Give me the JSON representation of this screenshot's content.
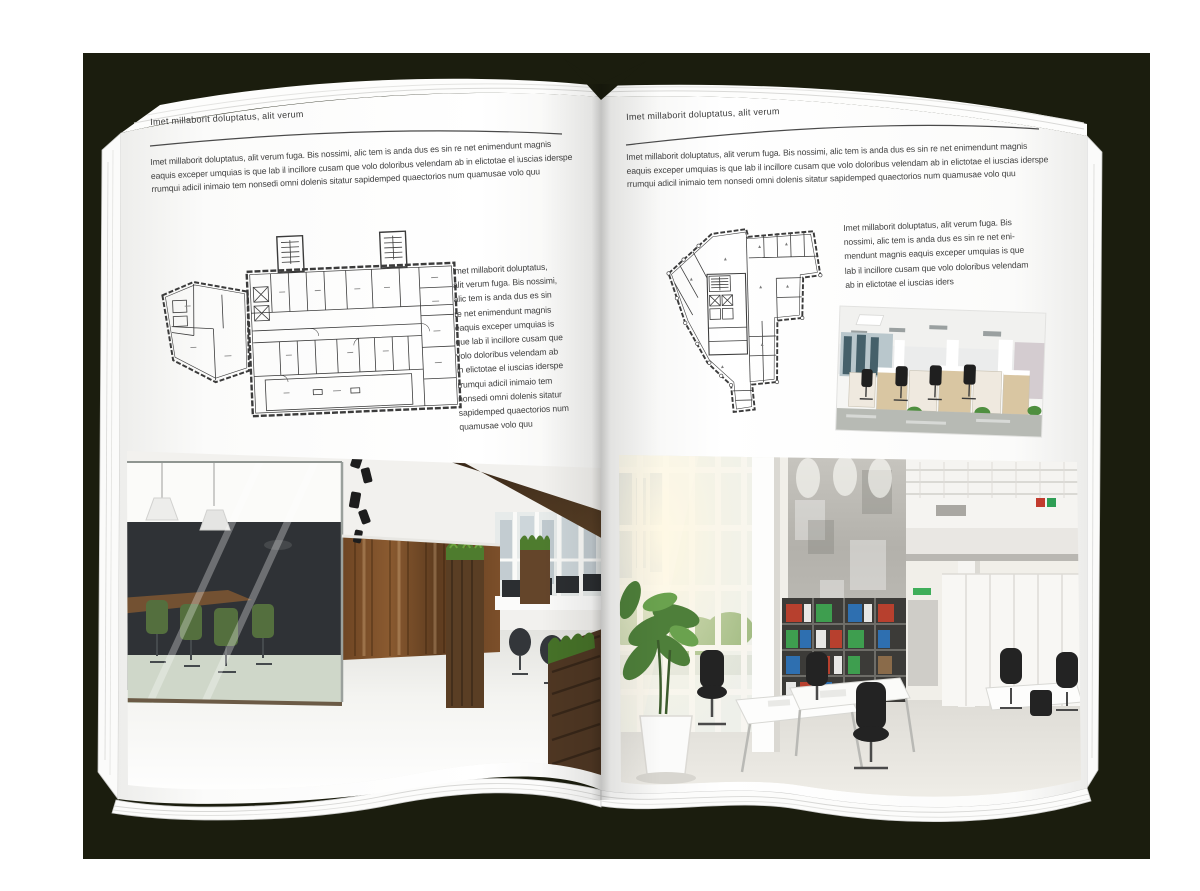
{
  "document": {
    "kind": "open-magazine-spread-mockup"
  },
  "colors": {
    "backdrop": "#1b1d0e",
    "paper": "#ffffff",
    "body_text": "#424242",
    "header_rule": "#4a4a4a",
    "plan_line": "#3b3b3b"
  },
  "left_page": {
    "header": "Imet millaborit doluptatus, alit verum",
    "intro_lines": [
      "Imet millaborit doluptatus, alit verum fuga. Bis nossimi, alic tem is anda dus es sin re net enimendunt magnis",
      "eaquis exceper umquias is que lab il incillore cusam que volo doloribus velendam ab in elictotae el iuscias iderspe",
      "rrumqui adicil inimaio tem nonsedi omni dolenis sitatur sapidemped quaectorios num quamusae volo quu"
    ],
    "sidebar_lines": [
      "Imet millaborit doluptatus,",
      "alit verum fuga. Bis nossimi,",
      "alic tem is anda dus es sin",
      "re net enimendunt magnis",
      "eaquis exceper umquias is",
      "que lab il incillore cusam que",
      "volo doloribus velendam ab",
      "in elictotae el iuscias iderspe",
      "rrumqui adicil inimaio tem",
      "nonsedi omni dolenis sitatur",
      "sapidemped quaectorios num",
      "quamusae volo quu"
    ],
    "floor_plan": "rectangular multi-wing office building plan with two stair towers",
    "photo": "loft office interior: glass meeting room with green chairs, dark wood accent wall, white floor"
  },
  "right_page": {
    "header": "Imet millaborit doluptatus, alit verum",
    "intro_lines": [
      "Imet millaborit doluptatus, alit verum fuga. Bis nossimi, alic tem is anda dus es sin re net enimendunt magnis",
      "eaquis exceper umquias is que lab il incillore cusam que volo doloribus velendam ab in elictotae el iuscias iderspe",
      "rrumqui adicil inimaio tem nonsedi omni dolenis sitatur sapidemped quaectorios num quamusae volo quu"
    ],
    "sidebar_lines": [
      "Imet millaborit doluptatus, alit verum fuga. Bis",
      "nossimi, alic tem is anda dus es sin re net eni-",
      "mendunt magnis eaquis exceper umquias is que",
      "lab il incillore cusam que volo doloribus velendam",
      "ab in elictotae el iuscias iders"
    ],
    "floor_plan": "irregular wedge-shaped office floor plan with central core",
    "photo_small": "bright open-plan office with light wood workstation cabinets and black chairs",
    "photo_large": "double-height white office atrium: tall windows, concrete wall, binder bookshelves, white desks"
  }
}
